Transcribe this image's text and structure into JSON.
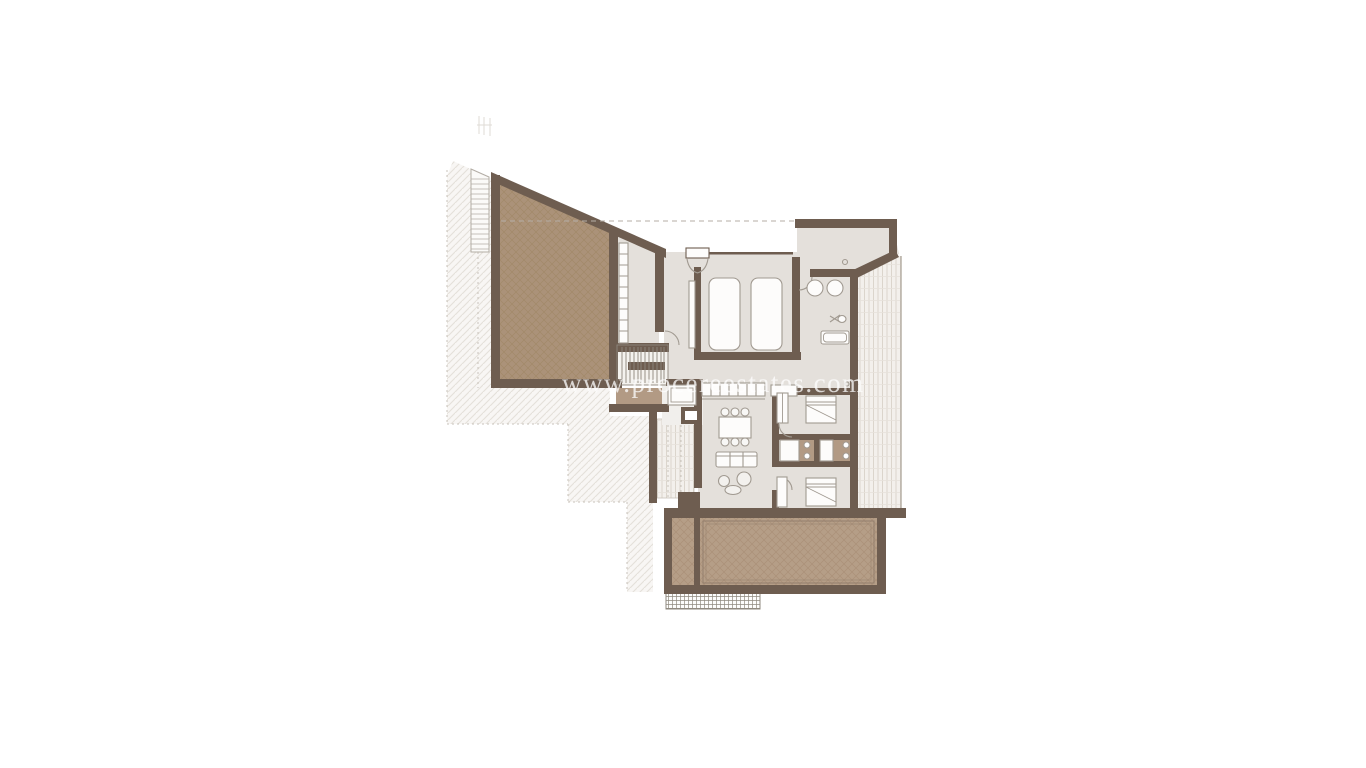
{
  "document": {
    "kind": "architectural-floor-plan",
    "background": "#ffffff"
  },
  "watermark": {
    "text": "www.procereestates.com"
  },
  "palette": {
    "wall": "#6e5d50",
    "floor": "#e4e0db",
    "stair_floor": "#f4f2ee",
    "tan_floor": "#b29a84",
    "roof_tan": "#ab9279",
    "roof_tan_line": "#a28969",
    "pool_tan": "#b59e87",
    "pool_tan_line": "#aa9078",
    "pool_edge": "#8f7b69",
    "deck_bg": "#f3f0ec",
    "deck_line": "#d9d2c9",
    "ground_line": "#e4e0da",
    "grid_line": "#8f897f",
    "furniture_stroke": "#a19a91",
    "furniture_fill": "#fdfcfb",
    "tread_line": "#8d867c",
    "dash_line": "#b5aea6",
    "watermark": "#ffffff"
  },
  "features": [
    "sloped-roof-terrace",
    "approach-ramp",
    "ground-hatch",
    "stair-hall",
    "shelving",
    "staircase",
    "elevator",
    "pantry",
    "entry-door",
    "twin-bedroom",
    "wardrobe",
    "master-bathroom",
    "vestibule",
    "east-terrace-deck",
    "kitchen-counter",
    "dining-set",
    "sofa",
    "lounge-chairs",
    "bedroom-1",
    "bedroom-2",
    "shower-room-1",
    "shower-room-2",
    "west-porch",
    "pool-terrace",
    "pool",
    "garden-grate"
  ]
}
